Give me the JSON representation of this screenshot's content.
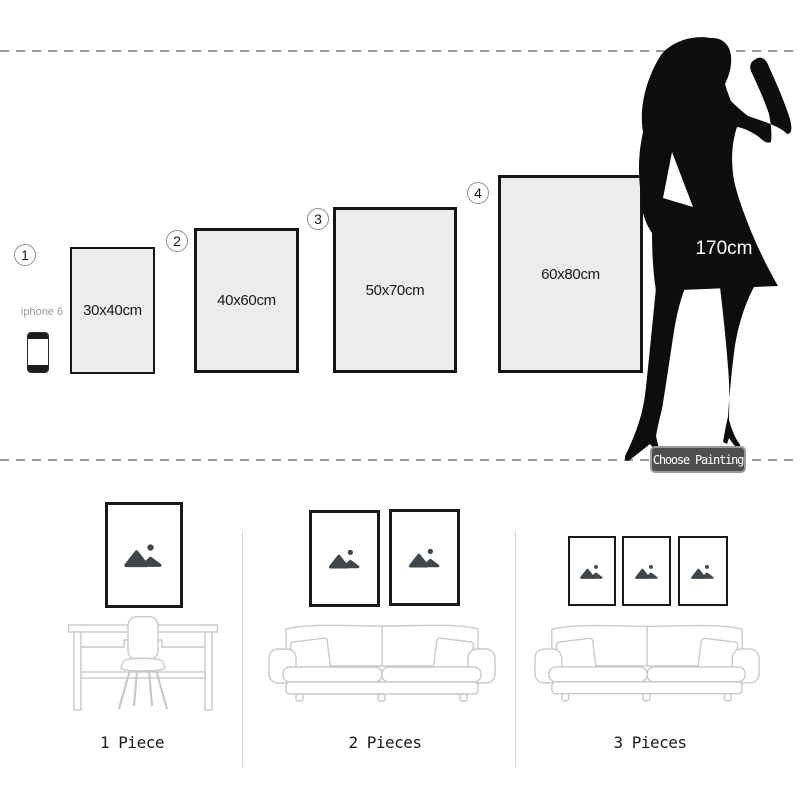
{
  "size_guide": {
    "model_height_label": "170cm",
    "phone_label": "iphone 6",
    "choose_button_label": "Choose Painting",
    "options": [
      {
        "number": "1",
        "size": "30x40cm"
      },
      {
        "number": "2",
        "size": "40x60cm"
      },
      {
        "number": "3",
        "size": "50x70cm"
      },
      {
        "number": "4",
        "size": "60x80cm"
      }
    ]
  },
  "room_previews": [
    {
      "label": "1 Piece",
      "frame_count": 1,
      "furniture": "desk-and-chair"
    },
    {
      "label": "2 Pieces",
      "frame_count": 2,
      "furniture": "sofa"
    },
    {
      "label": "3 Pieces",
      "frame_count": 3,
      "furniture": "sofa"
    }
  ],
  "icons": {
    "frame_placeholder": "mountain-image-icon",
    "model": "woman-silhouette-icon",
    "phone": "iphone-icon"
  },
  "colors": {
    "frame_fill": "#ececec",
    "frame_border": "#151515",
    "silhouette": "#0d0d0d",
    "placeholder_icon": "#3f474d",
    "furniture_outline": "#c9c9c9",
    "dashed_line": "#9a9a9a",
    "divider": "#d6d6d6",
    "button_bg": "#4f4f4f",
    "button_border": "#9a9a9a",
    "button_text": "#ffffff"
  }
}
